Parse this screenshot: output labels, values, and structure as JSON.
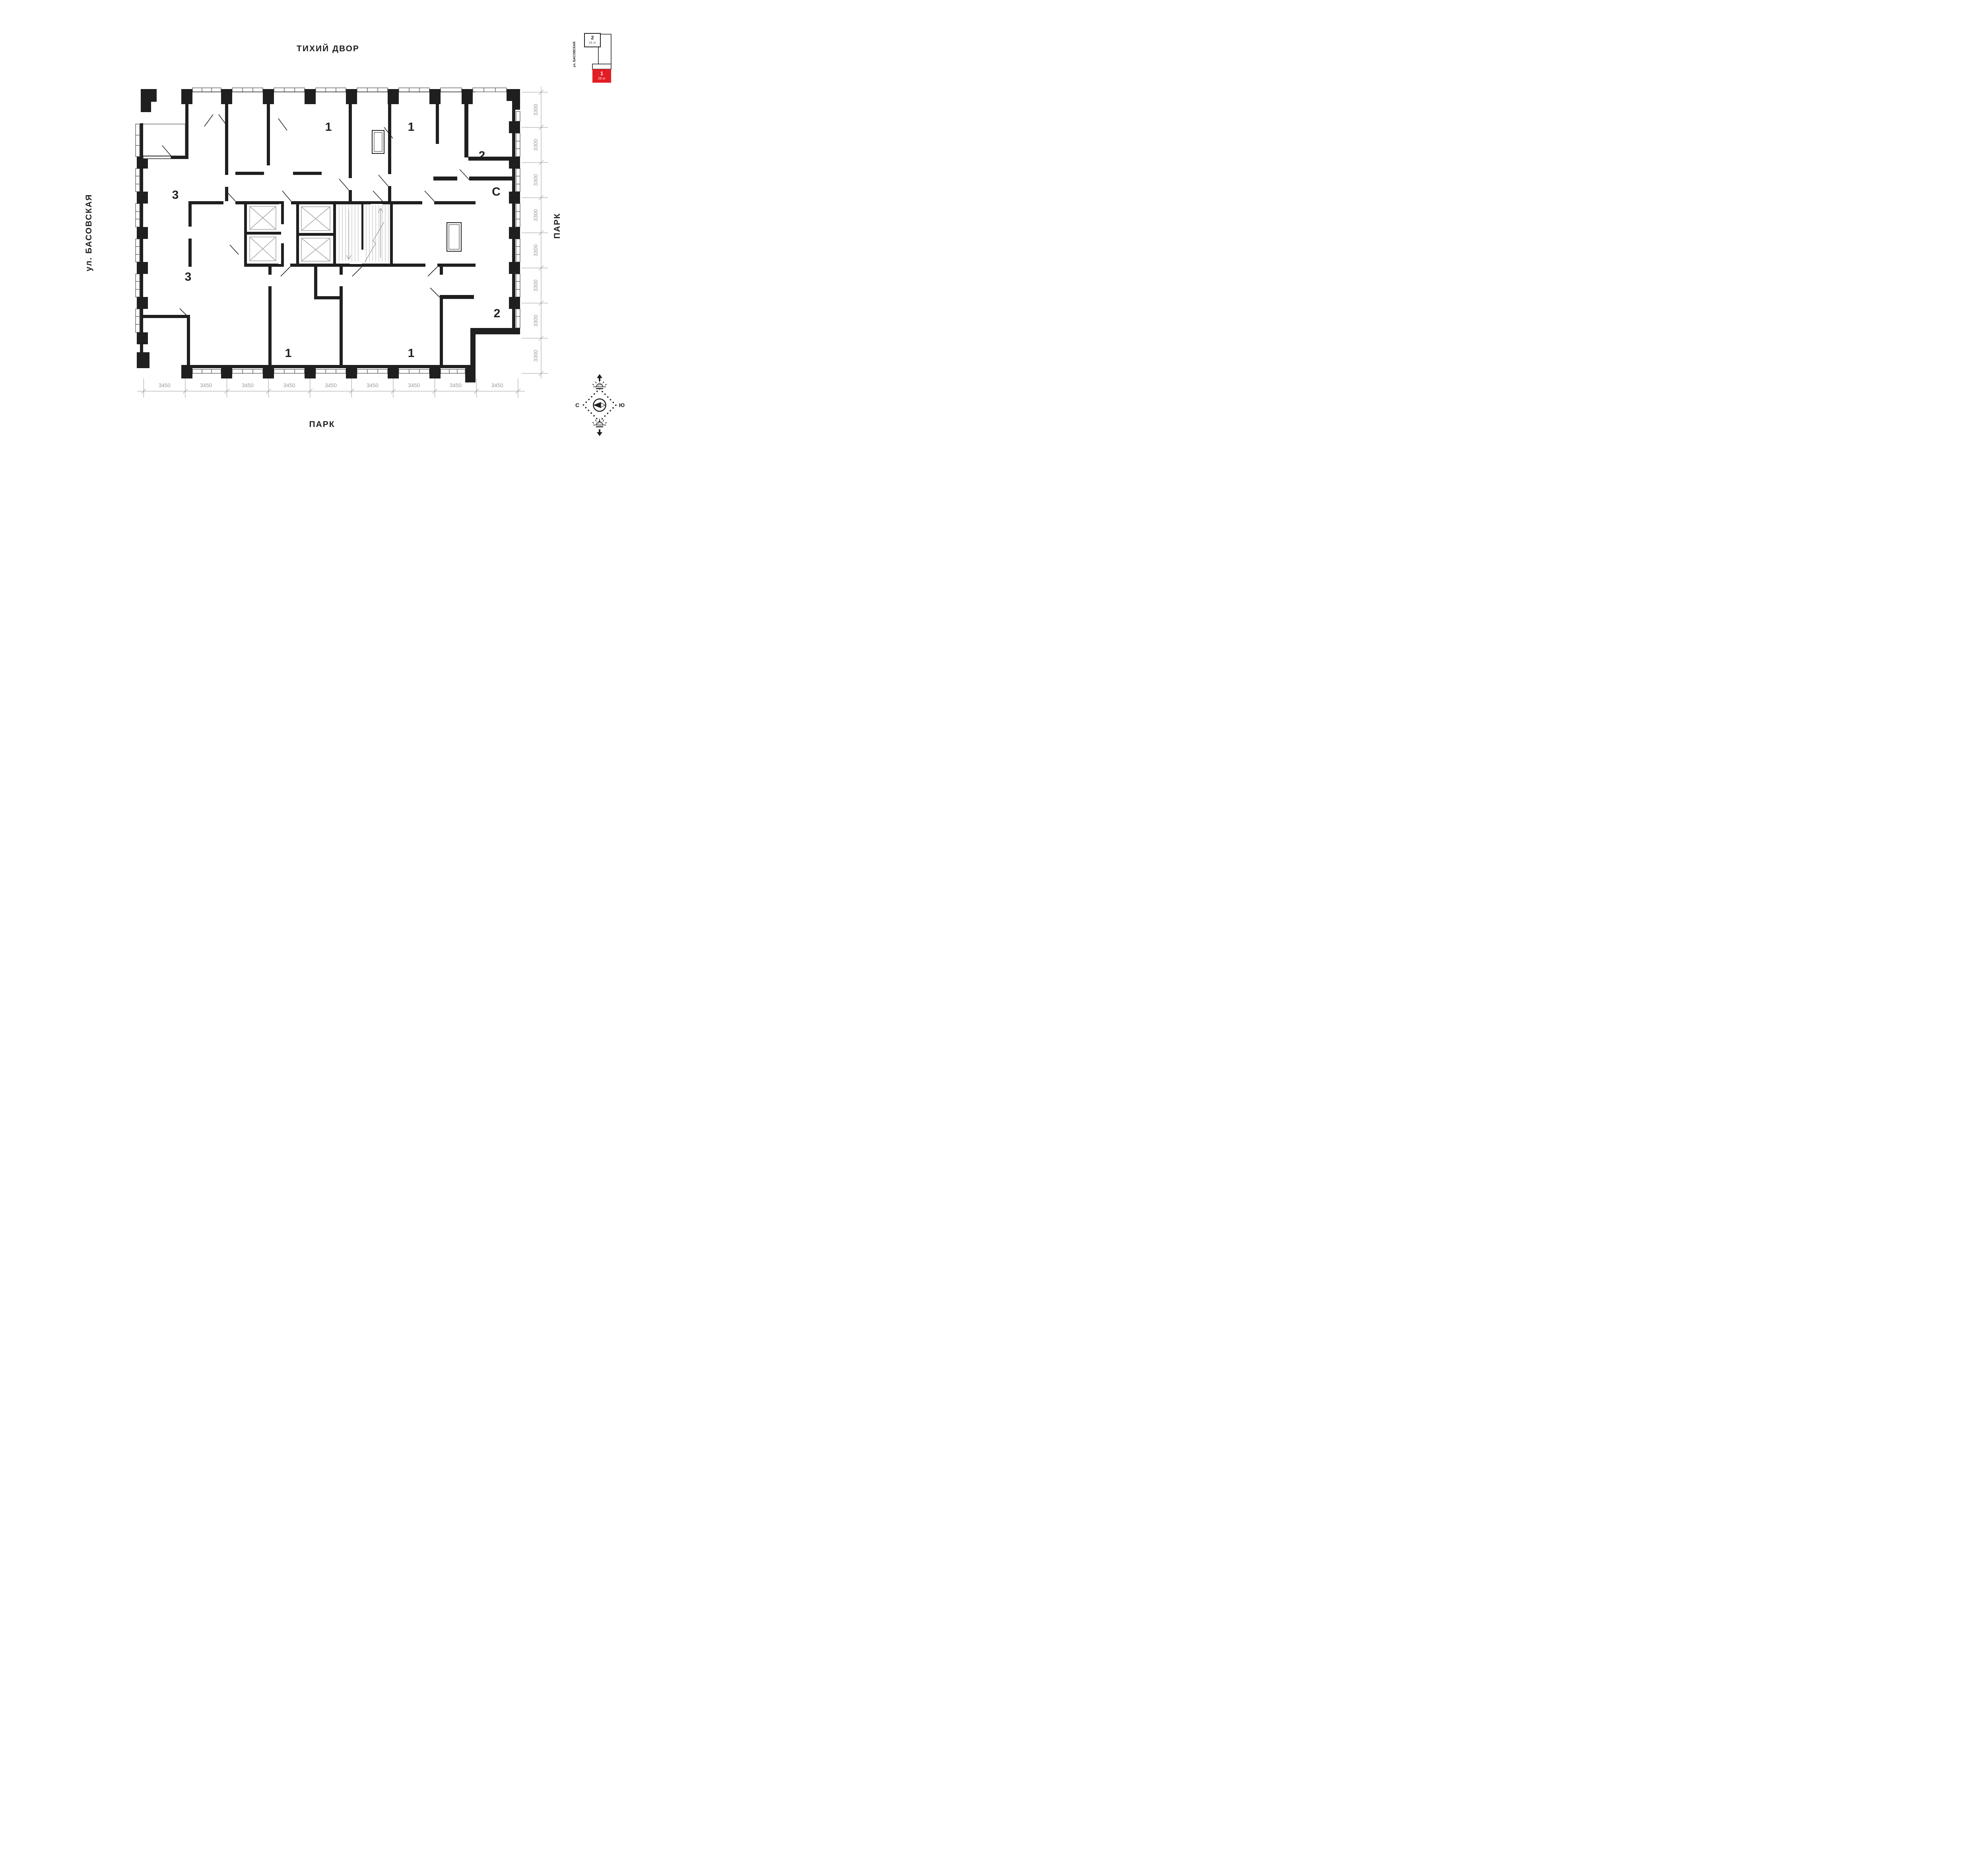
{
  "labels": {
    "top": "ТИХИЙ ДВОР",
    "left": "ул. БАСОВСКАЯ",
    "right": "ПАРК",
    "bottom": "ПАРК"
  },
  "plan": {
    "apartments": [
      {
        "id": "apt-1-top-left",
        "label": "1"
      },
      {
        "id": "apt-1-top-right",
        "label": "1"
      },
      {
        "id": "apt-2-top-right",
        "label": "2"
      },
      {
        "id": "apt-studio",
        "label": "С"
      },
      {
        "id": "apt-3-upper",
        "label": "3"
      },
      {
        "id": "apt-3-lower",
        "label": "3"
      },
      {
        "id": "apt-2-bottom",
        "label": "2"
      },
      {
        "id": "apt-1-bottom-left",
        "label": "1"
      },
      {
        "id": "apt-1-bottom-right",
        "label": "1"
      }
    ]
  },
  "dimensions": {
    "bottom": {
      "values": [
        "3450",
        "3450",
        "3450",
        "3450",
        "3450",
        "3450",
        "3450",
        "3450",
        "3450"
      ]
    },
    "right": {
      "values": [
        "3300",
        "3300",
        "3300",
        "3300",
        "3300",
        "3300",
        "3300",
        "3300"
      ]
    }
  },
  "minimap": {
    "street": "ул. БАСОВСКАЯ",
    "buildings": [
      {
        "number": "2",
        "floors": "16 эт",
        "highlighted": false
      },
      {
        "number": "1",
        "floors": "29 эт",
        "highlighted": true
      }
    ]
  },
  "compass": {
    "left": "С",
    "right": "Ю"
  },
  "colors": {
    "wall": "#1f1f1f",
    "dim_gray": "#9a9a9a",
    "accent_red": "#e21d24"
  }
}
